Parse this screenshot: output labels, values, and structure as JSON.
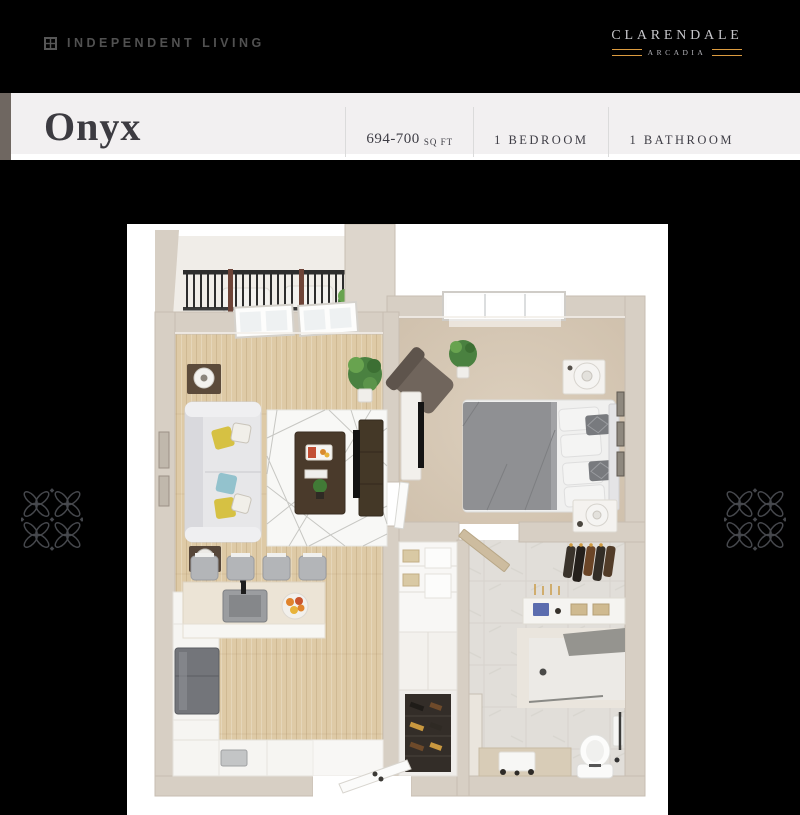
{
  "header": {
    "category_label": "INDEPENDENT LIVING",
    "logo": {
      "name": "CLARENDALE",
      "sub": "ARCADIA"
    }
  },
  "title_band": {
    "plan_name": "Onyx",
    "specs": [
      {
        "value": "694-700",
        "unit": "SQ FT"
      },
      {
        "value": "1 BEDROOM"
      },
      {
        "value": "1 BATHROOM"
      }
    ]
  },
  "floor_plan": {
    "type": "3d-floor-plan-render",
    "rooms": [
      "balcony",
      "living-room",
      "bedroom",
      "walk-in-closet",
      "bathroom",
      "kitchen",
      "entry",
      "laundry-storage"
    ]
  },
  "colors": {
    "page_bg": "#000000",
    "band_bg": "#f2f0f1",
    "band_accent_strip": "#6f6761",
    "title_text": "#3c3b41",
    "specs_text": "#3e3d45",
    "spec_divider": "#dbdbdb",
    "category_text": "#515151",
    "logo_text": "#c6c6ca",
    "logo_sub_text": "#b4b4ba",
    "logo_gold": "#dc9b3f",
    "pattern_stroke": "#46484d",
    "wall": "#d7cfc4",
    "wood_floor": "#decaa6",
    "carpet": "#d6c8b6",
    "tile": "#e1ded9",
    "rug": "#f8f8f6",
    "sofa": "#e7e7e9",
    "pillow_yellow": "#d6c143",
    "pillow_blue": "#93c2cd",
    "dark_wood": "#4a3a2b",
    "bed_gray": "#8f9093",
    "plant_green": "#4a8140",
    "railing": "#2d2d2d",
    "stainless": "#73757a",
    "fruit_orange": "#e0832c"
  }
}
